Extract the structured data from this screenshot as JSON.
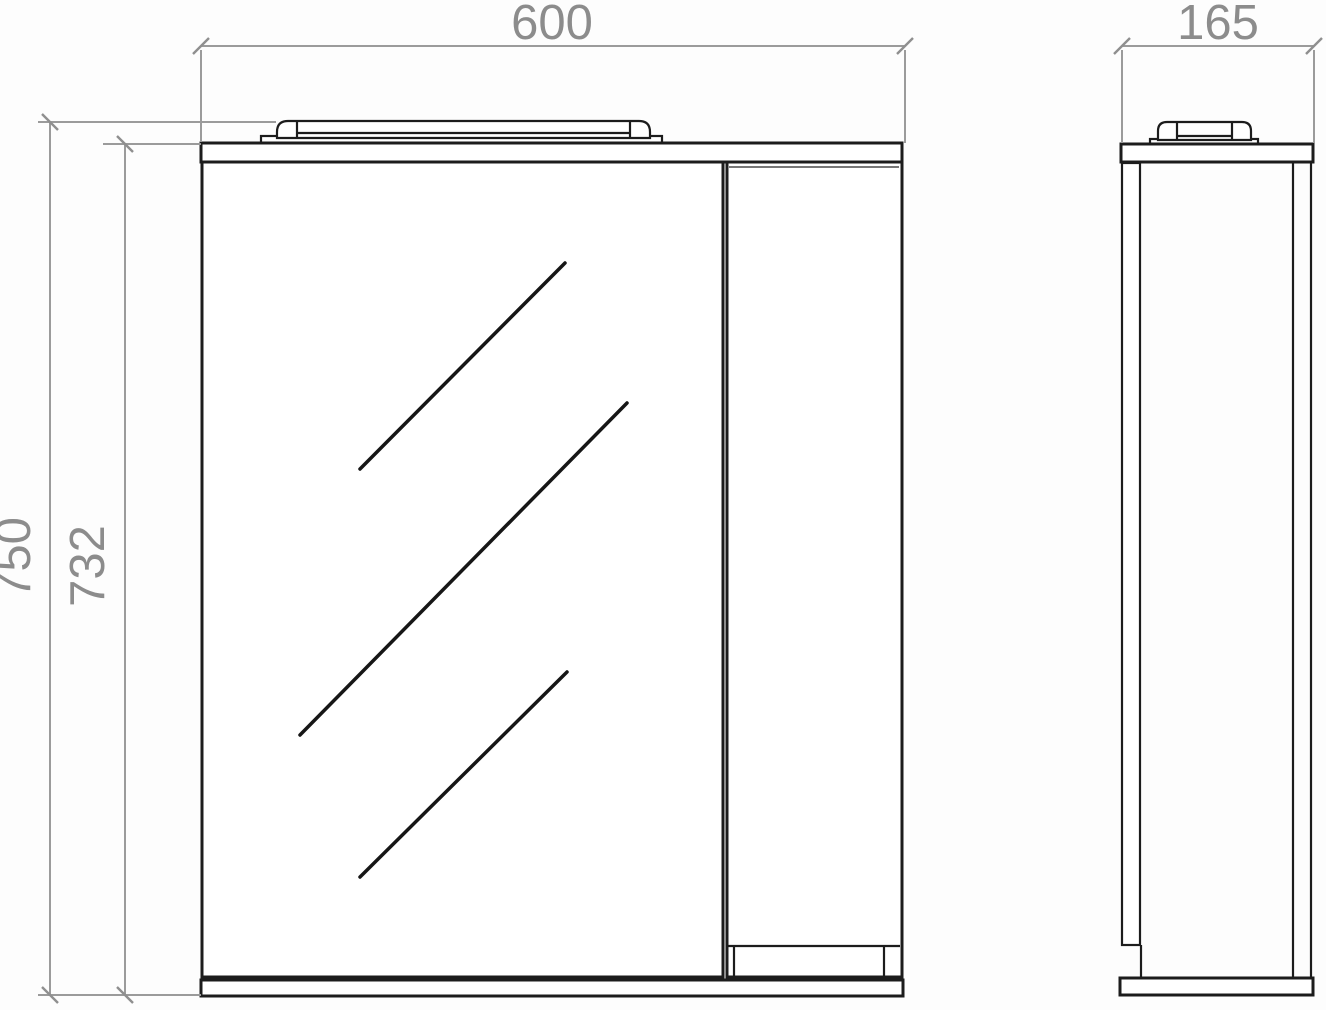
{
  "colors": {
    "background": "#fdfdfd",
    "outline": "#1c1c1c",
    "dimension_line": "#9b9b9b",
    "dimension_text": "#8c8c8c"
  },
  "dimensions": {
    "front_width": "600",
    "side_depth": "165",
    "overall_height": "750",
    "cabinet_height": "732"
  }
}
